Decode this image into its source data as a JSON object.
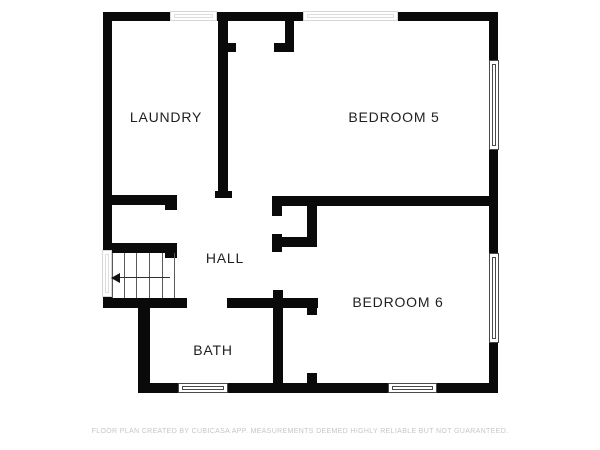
{
  "floorplan": {
    "background_color": "#ffffff",
    "wall_color": "#0a0a0a",
    "label_color": "#1f1f1f",
    "window_outline_color": "#4a4a4a",
    "faint_window_color": "#d6d6d6",
    "rooms": [
      {
        "label": "LAUNDRY",
        "cx": 166,
        "cy": 117
      },
      {
        "label": "BEDROOM 5",
        "cx": 394,
        "cy": 117
      },
      {
        "label": "HALL",
        "cx": 225,
        "cy": 258
      },
      {
        "label": "BEDROOM 6",
        "cx": 398,
        "cy": 302
      },
      {
        "label": "BATH",
        "cx": 213,
        "cy": 350
      }
    ],
    "walls": [
      {
        "id": "top-a",
        "x": 103,
        "y": 12,
        "w": 67,
        "h": 9
      },
      {
        "id": "top-b",
        "x": 217,
        "y": 12,
        "w": 86,
        "h": 9
      },
      {
        "id": "top-c",
        "x": 398,
        "y": 12,
        "w": 100,
        "h": 9
      },
      {
        "id": "left-upper",
        "x": 103,
        "y": 12,
        "w": 9,
        "h": 238
      },
      {
        "id": "left-lower",
        "x": 103,
        "y": 297,
        "w": 9,
        "h": 11
      },
      {
        "id": "right-upper",
        "x": 489,
        "y": 12,
        "w": 9,
        "h": 48
      },
      {
        "id": "right-middle",
        "x": 489,
        "y": 150,
        "w": 9,
        "h": 103
      },
      {
        "id": "right-lower",
        "x": 489,
        "y": 343,
        "w": 9,
        "h": 50
      },
      {
        "id": "bottom-a",
        "x": 138,
        "y": 383,
        "w": 40,
        "h": 10
      },
      {
        "id": "bottom-b",
        "x": 228,
        "y": 383,
        "w": 160,
        "h": 10
      },
      {
        "id": "bottom-c",
        "x": 437,
        "y": 383,
        "w": 61,
        "h": 10
      },
      {
        "id": "laundry-divider",
        "x": 218,
        "y": 12,
        "w": 10,
        "h": 186
      },
      {
        "id": "laundry-divider-cap",
        "x": 215,
        "y": 191,
        "w": 17,
        "h": 7
      },
      {
        "id": "laundry-bottom",
        "x": 103,
        "y": 195,
        "w": 74,
        "h": 10
      },
      {
        "id": "laundry-bottom-cap",
        "x": 165,
        "y": 195,
        "w": 12,
        "h": 15
      },
      {
        "id": "closet1-right",
        "x": 285,
        "y": 21,
        "w": 9,
        "h": 31
      },
      {
        "id": "closet1-stub-left",
        "x": 226,
        "y": 43,
        "w": 10,
        "h": 9
      },
      {
        "id": "closet1-stub-right",
        "x": 274,
        "y": 43,
        "w": 20,
        "h": 9
      },
      {
        "id": "bed5-bottom",
        "x": 272,
        "y": 196,
        "w": 226,
        "h": 10
      },
      {
        "id": "hall-stub-a",
        "x": 272,
        "y": 206,
        "w": 10,
        "h": 10
      },
      {
        "id": "hall-stub-b",
        "x": 272,
        "y": 234,
        "w": 10,
        "h": 18
      },
      {
        "id": "closet2-bottom",
        "x": 282,
        "y": 237,
        "w": 35,
        "h": 10
      },
      {
        "id": "closet2-right",
        "x": 307,
        "y": 206,
        "w": 10,
        "h": 41
      },
      {
        "id": "bath-right",
        "x": 273,
        "y": 290,
        "w": 10,
        "h": 100
      },
      {
        "id": "stairs-top",
        "x": 103,
        "y": 243,
        "w": 62,
        "h": 10
      },
      {
        "id": "stairs-top-cap",
        "x": 165,
        "y": 243,
        "w": 12,
        "h": 15
      },
      {
        "id": "stairs-bottom",
        "x": 103,
        "y": 298,
        "w": 84,
        "h": 10
      },
      {
        "id": "bath-top-right",
        "x": 227,
        "y": 298,
        "w": 91,
        "h": 10
      },
      {
        "id": "bath-left",
        "x": 138,
        "y": 308,
        "w": 12,
        "h": 85
      },
      {
        "id": "bed6-doorwall-top",
        "x": 307,
        "y": 298,
        "w": 10,
        "h": 17
      },
      {
        "id": "bed6-doorwall-bottom",
        "x": 307,
        "y": 373,
        "w": 10,
        "h": 10
      }
    ],
    "windows": [
      {
        "id": "laundry-top",
        "x": 170,
        "y": 11,
        "w": 47,
        "h": 10,
        "orient": "h",
        "faint": true
      },
      {
        "id": "bed5-top",
        "x": 303,
        "y": 11,
        "w": 95,
        "h": 10,
        "orient": "h",
        "faint": true
      },
      {
        "id": "stairs-left",
        "x": 102,
        "y": 250,
        "w": 10,
        "h": 47,
        "orient": "v",
        "faint": true
      },
      {
        "id": "bed5-right",
        "x": 489,
        "y": 60,
        "w": 10,
        "h": 90,
        "orient": "v",
        "faint": false
      },
      {
        "id": "bed6-right",
        "x": 489,
        "y": 253,
        "w": 10,
        "h": 90,
        "orient": "v",
        "faint": false
      },
      {
        "id": "bath-bottom",
        "x": 178,
        "y": 383,
        "w": 50,
        "h": 10,
        "orient": "h",
        "faint": false
      },
      {
        "id": "bed6-bottom",
        "x": 388,
        "y": 383,
        "w": 49,
        "h": 10,
        "orient": "h",
        "faint": false
      }
    ],
    "stairs": {
      "x": 112,
      "y": 253,
      "w": 63,
      "h": 45,
      "tread_offsets": [
        11,
        23,
        36,
        49
      ],
      "arrow": {
        "direction": "left",
        "y": 277,
        "x1": 113,
        "x2": 170
      }
    }
  },
  "footer": {
    "disclaimer": "FLOOR PLAN CREATED BY CUBICASA APP. MEASUREMENTS DEEMED HIGHLY RELIABLE BUT NOT GUARANTEED."
  }
}
